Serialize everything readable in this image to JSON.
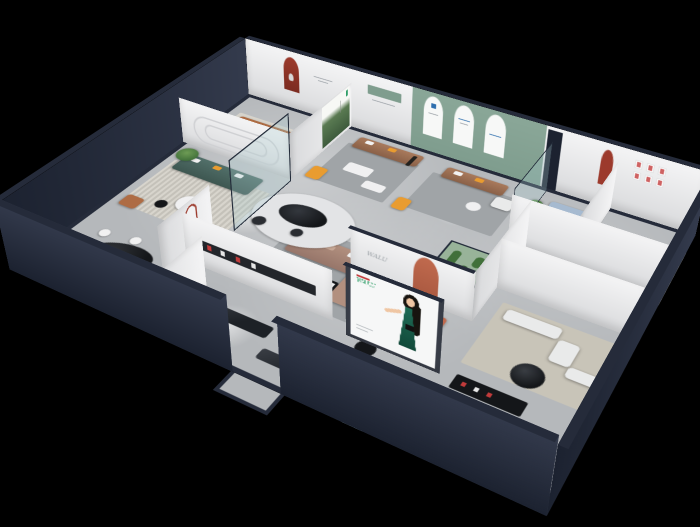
{
  "scene": {
    "title": "Furniture showroom – isometric 3D cutaway dollhouse render",
    "background": "#000000"
  },
  "signage": {
    "wall_logo": {
      "text": "WALU"
    },
    "brand_banner": {
      "logo_text": "WALU"
    }
  },
  "colors": {
    "wall_dark": "#1c2230",
    "wall_dark_hi": "#343b4d",
    "wall_cap": "#252b3a",
    "floor": "#b5b8bb",
    "wall_light_hi": "#f4f4f5",
    "wall_light": "#d9dadc",
    "sage": "#7f9d8e",
    "arch_red": "#9c3a2c",
    "logo_red": "#c23b3b",
    "logo_green": "#2f9e68",
    "logo_blue": "#2f6fae",
    "sofa_teal": "#52706a",
    "sofa_caramel": "#ae6c44",
    "sofa_taupe": "#b2907f",
    "sofa_brown": "#a97a5c",
    "sofa_lightblue": "#a6bad0",
    "sofa_white": "#e9eaea",
    "pillow_orange": "#e99c30",
    "pillow_white": "#f2f2f2",
    "plant": "#41703a",
    "terrarium": "#79a877",
    "rug_gray": "#a0a4a7",
    "rug_blue": "#a3bcd2",
    "rug_beige": "#c8c4b8",
    "rug_light": "#d6d3cb",
    "table_black": "#141619",
    "table_white": "#f0f0f1",
    "bed_coral": "#c06a4e",
    "bed_blue": "#b9cfe2",
    "glass_frame": "#232c3a",
    "glass_tint": "rgba(170,205,210,0.28)",
    "dress_green": "#1e6b55",
    "skin": "#efc6a3",
    "hair": "#17140f",
    "ottoman_teal": "#85aeb4",
    "chair_blue": "#7c99ab",
    "bench_dark": "#1d2126"
  }
}
